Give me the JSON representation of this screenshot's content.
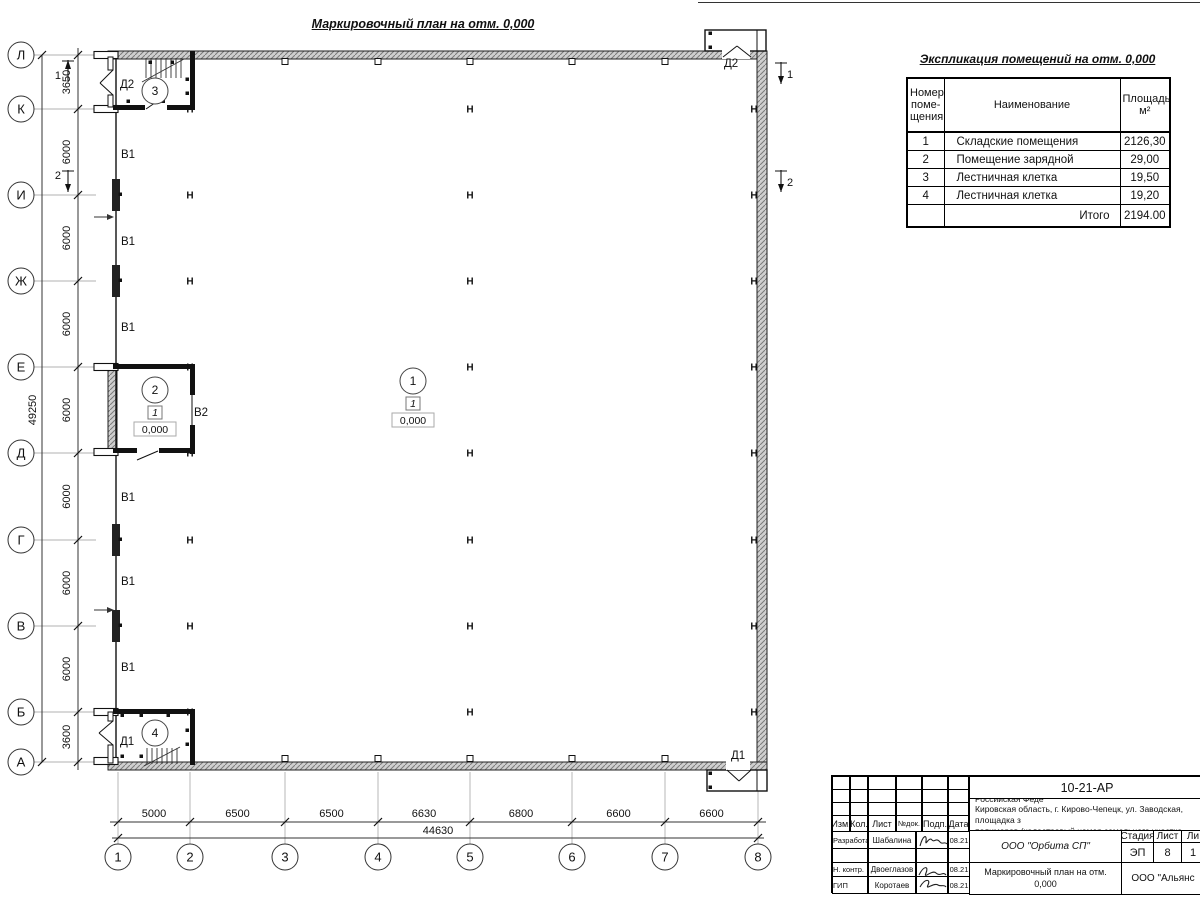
{
  "sheet": {
    "plan_title": "Маркировочный план на отм. 0,000"
  },
  "spec_table": {
    "title": "Экспликация помещений на отм. 0,000",
    "headers": {
      "number": "Номер\nпоме-\nщения",
      "name": "Наименование",
      "area": "Площадь,\nм²"
    },
    "rows": [
      [
        "1",
        "Складские помещения",
        "2126,30"
      ],
      [
        "2",
        "Помещение зарядной",
        "29,00"
      ],
      [
        "3",
        "Лестничная клетка",
        "19,50"
      ],
      [
        "4",
        "Лестничная клетка",
        "19,20"
      ]
    ],
    "total_label": "Итого",
    "total_value": "2194.00"
  },
  "title_block": {
    "doc_number": "10-21-АР",
    "description_lines": [
      "Здание склада АБК, расположенное по адресу: Российская Феде",
      "Кировская область, г. Кирово-Чепецк, ул. Заводская, площадка з",
      "полимеров (кадастровый номер земельного участка 43:42:00000"
    ],
    "change_header": [
      "Изм.",
      "Кол.",
      "Лист",
      "№док.",
      "Подп.",
      "Дата"
    ],
    "staff_rows": [
      {
        "role": "Разработал",
        "name": "Шабалина",
        "date": "08.21",
        "sign": true
      },
      {
        "role": "",
        "name": "",
        "date": "",
        "sign": false
      },
      {
        "role": "Н. контр.",
        "name": "Двоеглазов",
        "date": "08.21",
        "sign": true
      },
      {
        "role": "ГИП",
        "name": "Коротаев",
        "date": "08.21",
        "sign": true
      }
    ],
    "org": "ООО \"Орбита СП\"",
    "stage_header": [
      "Стадия",
      "Лист",
      "Ли"
    ],
    "stage_values": [
      "ЭП",
      "8",
      "1"
    ],
    "drawing_name": "Маркировочный план на отм.\n0,000",
    "company": "ООО \"Альянс"
  },
  "plan": {
    "axes_rows": [
      [
        "Л",
        55
      ],
      [
        "К",
        109
      ],
      [
        "И",
        195
      ],
      [
        "Ж",
        281
      ],
      [
        "Е",
        367
      ],
      [
        "Д",
        453
      ],
      [
        "Г",
        540
      ],
      [
        "В",
        626
      ],
      [
        "Б",
        712
      ],
      [
        "А",
        762
      ]
    ],
    "axes_cols": [
      [
        "1",
        118
      ],
      [
        "2",
        190
      ],
      [
        "3",
        285
      ],
      [
        "4",
        378
      ],
      [
        "5",
        470
      ],
      [
        "6",
        572
      ],
      [
        "7",
        665
      ],
      [
        "8",
        758
      ]
    ],
    "dims_left": [
      "3650",
      "6000",
      "6000",
      "6000",
      "6000",
      "6000",
      "6000",
      "6000",
      "3600"
    ],
    "total_left": "49250",
    "dims_bottom": [
      "5000",
      "6500",
      "6500",
      "6630",
      "6800",
      "6600",
      "6600"
    ],
    "total_bottom": "44630",
    "column_symbol": "Н",
    "columns": {
      "xs": [
        190,
        470,
        754
      ],
      "ys": [
        109,
        195,
        281,
        367,
        453,
        540,
        626,
        712
      ]
    },
    "gate_labels": [
      [
        "В1",
        121,
        158
      ],
      [
        "В1",
        121,
        245
      ],
      [
        "В1",
        121,
        331
      ],
      [
        "В2",
        194,
        416
      ],
      [
        "В1",
        121,
        501
      ],
      [
        "В1",
        121,
        585
      ],
      [
        "В1",
        121,
        671
      ]
    ],
    "door_labels": [
      [
        "Д2",
        120,
        88
      ],
      [
        "Д2",
        724,
        67
      ],
      [
        "Д1",
        120,
        745
      ],
      [
        "Д1",
        731,
        759
      ]
    ],
    "rooms": [
      {
        "num": "1",
        "x": 413,
        "y": 381,
        "floor": "1",
        "level": "0,000"
      },
      {
        "num": "2",
        "x": 155,
        "y": 390,
        "floor": "1",
        "level": "0,000"
      },
      {
        "num": "3",
        "x": 155,
        "y": 91
      },
      {
        "num": "4",
        "x": 155,
        "y": 733
      }
    ],
    "section_marks": [
      {
        "label": "1",
        "x": 68,
        "y1": 60,
        "y2": 82,
        "dir": "up",
        "side": "left"
      },
      {
        "label": "2",
        "x": 68,
        "y1": 170,
        "y2": 192,
        "dir": "down",
        "side": "left"
      },
      {
        "label": "1",
        "x": 781,
        "y1": 62,
        "y2": 84,
        "dir": "down",
        "side": "right"
      },
      {
        "label": "2",
        "x": 781,
        "y1": 170,
        "y2": 192,
        "dir": "down",
        "side": "right"
      }
    ]
  }
}
